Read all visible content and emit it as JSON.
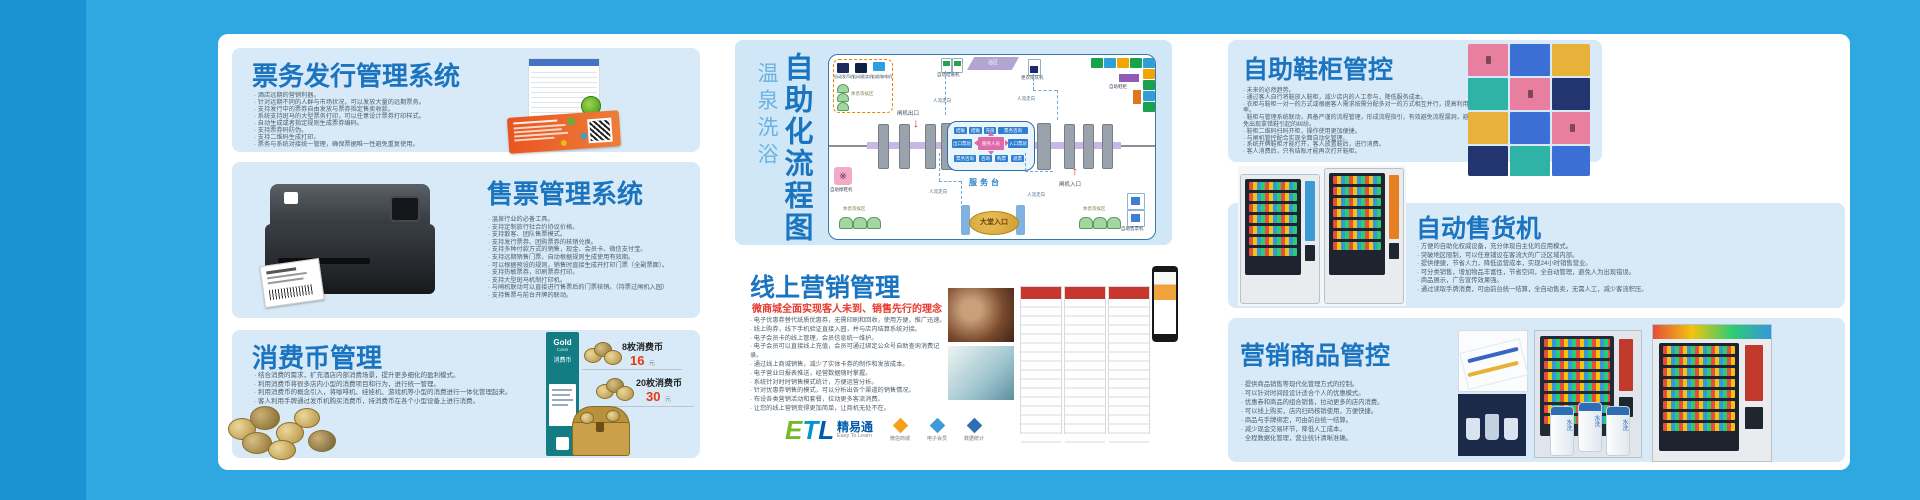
{
  "panels": {
    "ticket_issuing": {
      "title": "票务发行管理系统",
      "bullets": [
        "酒店远期的营销利器。",
        "针对远期不同的人群与市场状况，可以发放大量的远期票务。",
        "支持发行中的票券自由发放与票券指定售卖收款。",
        "系统支持斑马的大型票务打印，可以任意设计票券打印样式。",
        "自动生成或者指定规则生成票券编码。",
        "支持票券码防伪。",
        "支持二维码生成打印。",
        "票务与系统对接统一管理，确保票据唯一性避免重复使用。"
      ]
    },
    "ticket_sales": {
      "title": "售票管理系统",
      "bullets": [
        "温泉行业的必备工具。",
        "支持定制旅行社合约协议价格。",
        "支持散客、团队售票模式。",
        "支持发行票券、团购票券的核销兑换。",
        "支持多种付款方式的销售，现金、会员卡、微信支付宝。",
        "支持远期销售门票，自动根据规则生成使用有效期。",
        "可以根据预设的规则，销售时直接生成开打印门票（全副票面）。",
        "支持热敏票券，印刷票券打印。",
        "支持大型斑马机制打印机。",
        "与闸机联动可以直接进行售票后的门票核销。（持票过闸机入园）",
        "支持售票与前台开牌的联动。"
      ]
    },
    "coin_mgmt": {
      "title": "消费币管理",
      "bullets": [
        "结合消费的需求，扩充酒店内部消费场景，提升更多细化的盈利模式。",
        "利用消费币将很多店内小型的消费项目和行为，进行统一管理。",
        "利用消费币的概念引入，将咖啡机、娃娃机、游戏机等小型的消费进行一体化管理起来。",
        "客人利用手牌通过发币机购买消费币，持消费币在各个小型设备上进行消费。"
      ],
      "card": {
        "brand": "Gold",
        "brand_sub": "Coins",
        "name": "消费币"
      },
      "prices": [
        {
          "label": "8枚消费币",
          "price": "16",
          "unit": "元"
        },
        {
          "label": "20枚消费币",
          "price": "30",
          "unit": "元"
        }
      ]
    },
    "flow": {
      "title": "自助化流程图",
      "subtitle": "温泉洗浴",
      "labels": {
        "coin_machine": "自动发币机",
        "vending": "自动贩卖机",
        "coffee": "自助咖啡机",
        "rest_area": "休息等候区",
        "checkout": "自动结账机",
        "bath_area": "浴区",
        "queue": "更衣排队机",
        "shoe_locker": "自助鞋柜",
        "gate_exit": "闸机出口",
        "gate_entry": "闸机入口",
        "service_desk": "服务台",
        "hall_entrance": "大堂入口",
        "shoe_polish": "自助擦鞋机",
        "ticket_machine": "自助售票机",
        "people_flow": "人流走向",
        "center": {
          "top": [
            "结账",
            "结账",
            "充值",
            "票务咨询"
          ],
          "mid_left": "出口票验",
          "mid_center": "服务人员",
          "mid_right": "入口票验",
          "bottom": [
            "票务咨询",
            "咨询",
            "购票",
            "退票"
          ]
        }
      }
    },
    "online_marketing": {
      "title": "线上营销管理",
      "subtitle": "微商城全面实现客人未到、销售先行的理念",
      "bullets": [
        "电子优惠券替代纸质优惠券，无需印刷和回收，使用方便，推广迅速。",
        "线上购券，线下手机验证直接入园，并与店内结算系统对接。",
        "电子会员卡的线上管理，会员信息统一维护。",
        "电子会员可以直接线上充值，会员可通过绑定公众号自助查询消费记录。",
        "通过线上商城销售，减少了实体卡券的制作和发放成本。",
        "电子营业日报表推送，经营数据随时掌握。",
        "系统针对时时销售模式统计，方便运营分析。",
        "针对优惠券销售的模式，可以分析出各个渠道的销售情况。",
        "布设各类营销活动和套餐，拉动更多客流消费。",
        "让您的线上营销变得更加简单，让商机无处不在。"
      ],
      "logo": {
        "e": "E",
        "t": "T",
        "l": "L",
        "name": "精易通",
        "tagline": "Easy To Learn"
      },
      "badges": [
        {
          "label": "微信商城"
        },
        {
          "label": "电子会员"
        },
        {
          "label": "数据统计"
        }
      ]
    },
    "shoe_cabinet": {
      "title": "自助鞋柜管控",
      "bullets": [
        "未来的必然趋势。",
        "通过客人自行将鞋放入鞋柜，减少店内的人工参与，降低服务成本。",
        "衣柜与鞋柜一对一的方式或根据客人需求按需分配多对一的方式相互并行，提高利用率。",
        "鞋柜与管理系统联动，具备严谨的流程管理，形成流程指引，有效避免流程漏洞，避免出现拿错鞋引起的纠纷。",
        "鞋柜二维码扫码开柜，操作使用更加便捷。",
        "与闸机管控配合实现全面自动化管理。",
        "系统开牌鞋柜才能打开，客人放置鞋后，进行消费。",
        "客人消费后，只有结账才能再次打开鞋柜。"
      ]
    },
    "vending": {
      "title": "自动售货机",
      "bullets": [
        "方便的自助化权威设备，充分体现自主化的应用模式。",
        "突破地区限制，可以任意铺设在客流大的广泛区域内部。",
        "提供便捷，节省人力，降低运营成本，实现24小时销售营业。",
        "可分类销售，增加物品丰富性，节省空间，全自动管理，避免人为出现错误。",
        "商品展示，广告宣传效果强。",
        "通过读取手牌消费，可由前台统一结算，全自动售卖，无需人工，减少客流积压。"
      ]
    },
    "marketing_goods": {
      "title": "营销商品管控",
      "bullets": [
        "提供商品销售等现代化管理方式的控制。",
        "可以针对时间段设计适合个人的优惠模式。",
        "优惠券和商品的组合销售，拉动更多的店内消费。",
        "可以线上购买，店内扫码核销使用，方便快捷。",
        "商品与手牌绑定，可由前台统一结算。",
        "减少现金交易环节，降低人工成本。",
        "全程数据化管理，营业统计清晰准确。"
      ],
      "bottle_label": "水洗"
    }
  }
}
